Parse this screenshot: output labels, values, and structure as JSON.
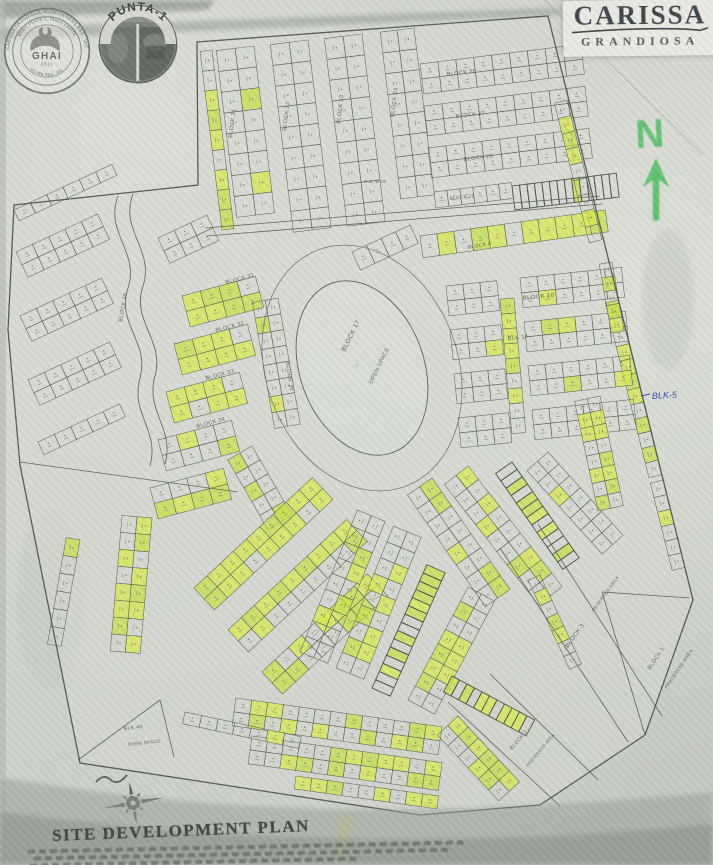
{
  "title": {
    "main": "CARISSA",
    "sub": "GRANDIOSA"
  },
  "seals": {
    "ghai": {
      "outer_ring": "CARISSA GRANDIOSA HOMEOWNERS ASS., INC.",
      "inner_ring": "BRGY. PUNTA 1, TANZA CAVITE",
      "bottom_ring": "HLURB REG. NO.",
      "name": "GHAI",
      "year": "2011"
    },
    "punta": {
      "arc": "PUNTA-1"
    }
  },
  "north_label": "N",
  "handwritten_note": "BLK-5",
  "footer": {
    "title": "SITE DEVELOPMENT PLAN"
  },
  "colors": {
    "paper": "#d3d7cf",
    "ink": "#4d524e",
    "lot_line": "#5d635c",
    "highlight": "#d9e94f",
    "highlight2": "#c7e24a",
    "marker_green": "#4fbe63",
    "hand_blue": "#3c49a8",
    "band": "#9ba19a",
    "seal": "#71766f"
  },
  "map": {
    "labels": [
      [
        "BLOCK 21",
        232,
        138,
        -83,
        5.5
      ],
      [
        "BLOCK 22",
        286,
        131,
        -83,
        5.5
      ],
      [
        "BLOCK 23",
        340,
        124,
        -83,
        5.5
      ],
      [
        "BLOCK 24",
        394,
        117,
        -83,
        5.5
      ],
      [
        "BLOCK 28",
        447,
        76,
        -7,
        5.5
      ],
      [
        "BLOCK 27",
        456,
        118,
        -7,
        5.5
      ],
      [
        "BLOCK 26",
        464,
        161,
        -7,
        5.5
      ],
      [
        "BLOCK 19",
        450,
        200,
        -7,
        4.5
      ],
      [
        "O.S. B-29",
        364,
        183,
        0,
        4.2
      ],
      [
        "BLOCK 6",
        468,
        249,
        -10,
        5
      ],
      [
        "BLOCK 18",
        523,
        300,
        -6,
        6
      ],
      [
        "BLK 14",
        508,
        340,
        -6,
        5.5
      ],
      [
        "BLOCK 17",
        345,
        352,
        -64,
        6.5
      ],
      [
        "~",
        358,
        368,
        -64,
        6
      ],
      [
        "OPEN SPACE",
        372,
        384,
        -64,
        5.5
      ],
      [
        "BLOCK 46",
        122,
        322,
        -80,
        5.5
      ],
      [
        "BLOCK 31",
        226,
        284,
        -15,
        5.5
      ],
      [
        "BLOCK 32",
        216,
        332,
        -15,
        5.5
      ],
      [
        "BLOCK 33",
        206,
        380,
        -15,
        5.5
      ],
      [
        "BLOCK 34",
        197,
        428,
        -15,
        5.5
      ],
      [
        "BLOCK 30",
        286,
        362,
        82,
        5.5
      ],
      [
        "BLOCK 3",
        568,
        648,
        -54,
        6
      ],
      [
        "RESERVED AREA",
        594,
        612,
        -54,
        4.5
      ],
      [
        "BLOCK 2",
        512,
        750,
        -50,
        5
      ],
      [
        "PRESERVED AREA",
        528,
        767,
        -50,
        4
      ],
      [
        "BLOCK 1",
        650,
        670,
        -56,
        5.5
      ],
      [
        "PRESERVED AREA",
        667,
        689,
        -56,
        4.5
      ],
      [
        "BLK 49",
        124,
        730,
        -6,
        5
      ],
      [
        "OPEN SPACE",
        128,
        746,
        -6,
        4.5
      ]
    ],
    "strips": [
      [
        83,
        254,
        46,
        8,
        21,
        19,
        2,
        0.05,
        1
      ],
      [
        83,
        308,
        40,
        9,
        21,
        19,
        2,
        0,
        2
      ],
      [
        83,
        362,
        34,
        9,
        21,
        19,
        2,
        0,
        3
      ],
      [
        83,
        414,
        28,
        8,
        21,
        17,
        2,
        0,
        4
      ],
      [
        83,
        212,
        50,
        9,
        20,
        12,
        1,
        0.3,
        5
      ],
      [
        -7,
        420,
        64,
        9,
        18,
        15,
        2,
        0.04,
        6
      ],
      [
        -7,
        424,
        106,
        9,
        18,
        15,
        2,
        0,
        7
      ],
      [
        -7,
        428,
        148,
        9,
        18,
        15,
        2,
        0,
        8
      ],
      [
        -7,
        434,
        192,
        6,
        13,
        16,
        1,
        0,
        9
      ],
      [
        -7,
        512,
        186,
        14,
        7.5,
        24,
        1,
        0.07,
        10,
        1
      ],
      [
        -8,
        420,
        236,
        11,
        17,
        22,
        1,
        0.8,
        11
      ],
      [
        -25,
        352,
        252,
        4,
        16,
        20,
        1,
        0.5,
        12
      ],
      [
        76,
        567,
        100,
        9,
        16,
        13,
        1,
        0.5,
        13
      ],
      [
        76,
        618,
        300,
        12,
        15,
        13,
        1,
        0.55,
        14
      ],
      [
        76,
        663,
        480,
        6,
        15,
        13,
        1,
        0.2,
        15
      ],
      [
        -25,
        16,
        252,
        5,
        18,
        14,
        2,
        0,
        16
      ],
      [
        -25,
        20,
        316,
        5,
        18,
        14,
        2,
        0.03,
        17
      ],
      [
        -25,
        28,
        380,
        5,
        18,
        14,
        2,
        0,
        18
      ],
      [
        -25,
        38,
        442,
        5,
        18,
        14,
        1,
        0,
        19
      ],
      [
        -25,
        14,
        210,
        6,
        18,
        12,
        1,
        0,
        20
      ],
      [
        -25,
        158,
        238,
        3,
        18,
        14,
        2,
        0,
        21
      ],
      [
        -15,
        182,
        296,
        4,
        19,
        16,
        2,
        0.8,
        22
      ],
      [
        -15,
        174,
        344,
        4,
        19,
        16,
        2,
        0.85,
        23
      ],
      [
        -15,
        166,
        392,
        4,
        19,
        16,
        2,
        0.8,
        24
      ],
      [
        -15,
        158,
        440,
        4,
        19,
        16,
        2,
        0.7,
        25
      ],
      [
        -15,
        150,
        488,
        4,
        19,
        16,
        2,
        0.6,
        26
      ],
      [
        80,
        278,
        298,
        8,
        16,
        13,
        2,
        0.12,
        27
      ],
      [
        60,
        252,
        446,
        5,
        16,
        14,
        2,
        0.3,
        28
      ],
      [
        -6,
        446,
        286,
        3,
        17,
        15,
        2,
        0.05,
        29
      ],
      [
        -6,
        520,
        278,
        6,
        17,
        15,
        2,
        0.1,
        30
      ],
      [
        -6,
        450,
        330,
        3,
        17,
        15,
        2,
        0.08,
        31
      ],
      [
        -6,
        524,
        322,
        6,
        17,
        15,
        2,
        0.1,
        32
      ],
      [
        -6,
        454,
        374,
        3,
        17,
        15,
        2,
        0.1,
        33
      ],
      [
        -6,
        528,
        366,
        6,
        17,
        15,
        2,
        0.12,
        34
      ],
      [
        -6,
        458,
        418,
        3,
        17,
        15,
        2,
        0.1,
        35
      ],
      [
        -6,
        532,
        410,
        6,
        17,
        15,
        2,
        0.15,
        36
      ],
      [
        85,
        514,
        298,
        9,
        15,
        14,
        1,
        0.85,
        37
      ],
      [
        80,
        612,
        262,
        5,
        14,
        13,
        1,
        0.8,
        38
      ],
      [
        78,
        600,
        396,
        8,
        14,
        13,
        2,
        0.45,
        39
      ],
      [
        -43,
        194,
        588,
        9,
        18,
        15,
        2,
        0.8,
        40
      ],
      [
        -43,
        228,
        630,
        9,
        18,
        15,
        2,
        0.75,
        41
      ],
      [
        -43,
        262,
        672,
        8,
        18,
        15,
        2,
        0.7,
        42
      ],
      [
        95,
        152,
        518,
        8,
        17,
        15,
        2,
        0.6,
        43
      ],
      [
        100,
        80,
        540,
        6,
        18,
        14,
        1,
        0.08,
        44
      ],
      [
        -68,
        300,
        652,
        9,
        17,
        15,
        2,
        0.3,
        45
      ],
      [
        -68,
        336,
        668,
        9,
        17,
        15,
        2,
        0.35,
        46
      ],
      [
        -66,
        372,
        688,
        15,
        9,
        20,
        1,
        0.45,
        47,
        1
      ],
      [
        -62,
        408,
        700,
        8,
        16,
        15,
        2,
        0.3,
        48
      ],
      [
        55,
        432,
        478,
        8,
        17,
        15,
        2,
        0.3,
        49
      ],
      [
        52,
        468,
        466,
        9,
        17,
        15,
        2,
        0.35,
        50
      ],
      [
        55,
        512,
        462,
        13,
        9,
        20,
        1,
        0.35,
        51,
        1
      ],
      [
        48,
        548,
        452,
        7,
        16,
        14,
        2,
        0.3,
        52
      ],
      [
        65,
        540,
        575,
        7,
        14,
        13,
        1,
        0.6,
        59
      ],
      [
        8,
        236,
        698,
        13,
        16,
        14,
        2,
        0.3,
        53
      ],
      [
        8,
        252,
        736,
        12,
        16,
        14,
        2,
        0.5,
        54
      ],
      [
        8,
        296,
        776,
        9,
        16,
        13,
        1,
        0.5,
        55
      ],
      [
        28,
        452,
        676,
        11,
        8.5,
        18,
        1,
        0.3,
        56,
        1
      ],
      [
        47,
        458,
        716,
        6,
        15,
        14,
        2,
        0.55,
        57
      ],
      [
        12,
        185,
        712,
        7,
        17,
        12,
        1,
        0.15,
        58
      ]
    ]
  }
}
